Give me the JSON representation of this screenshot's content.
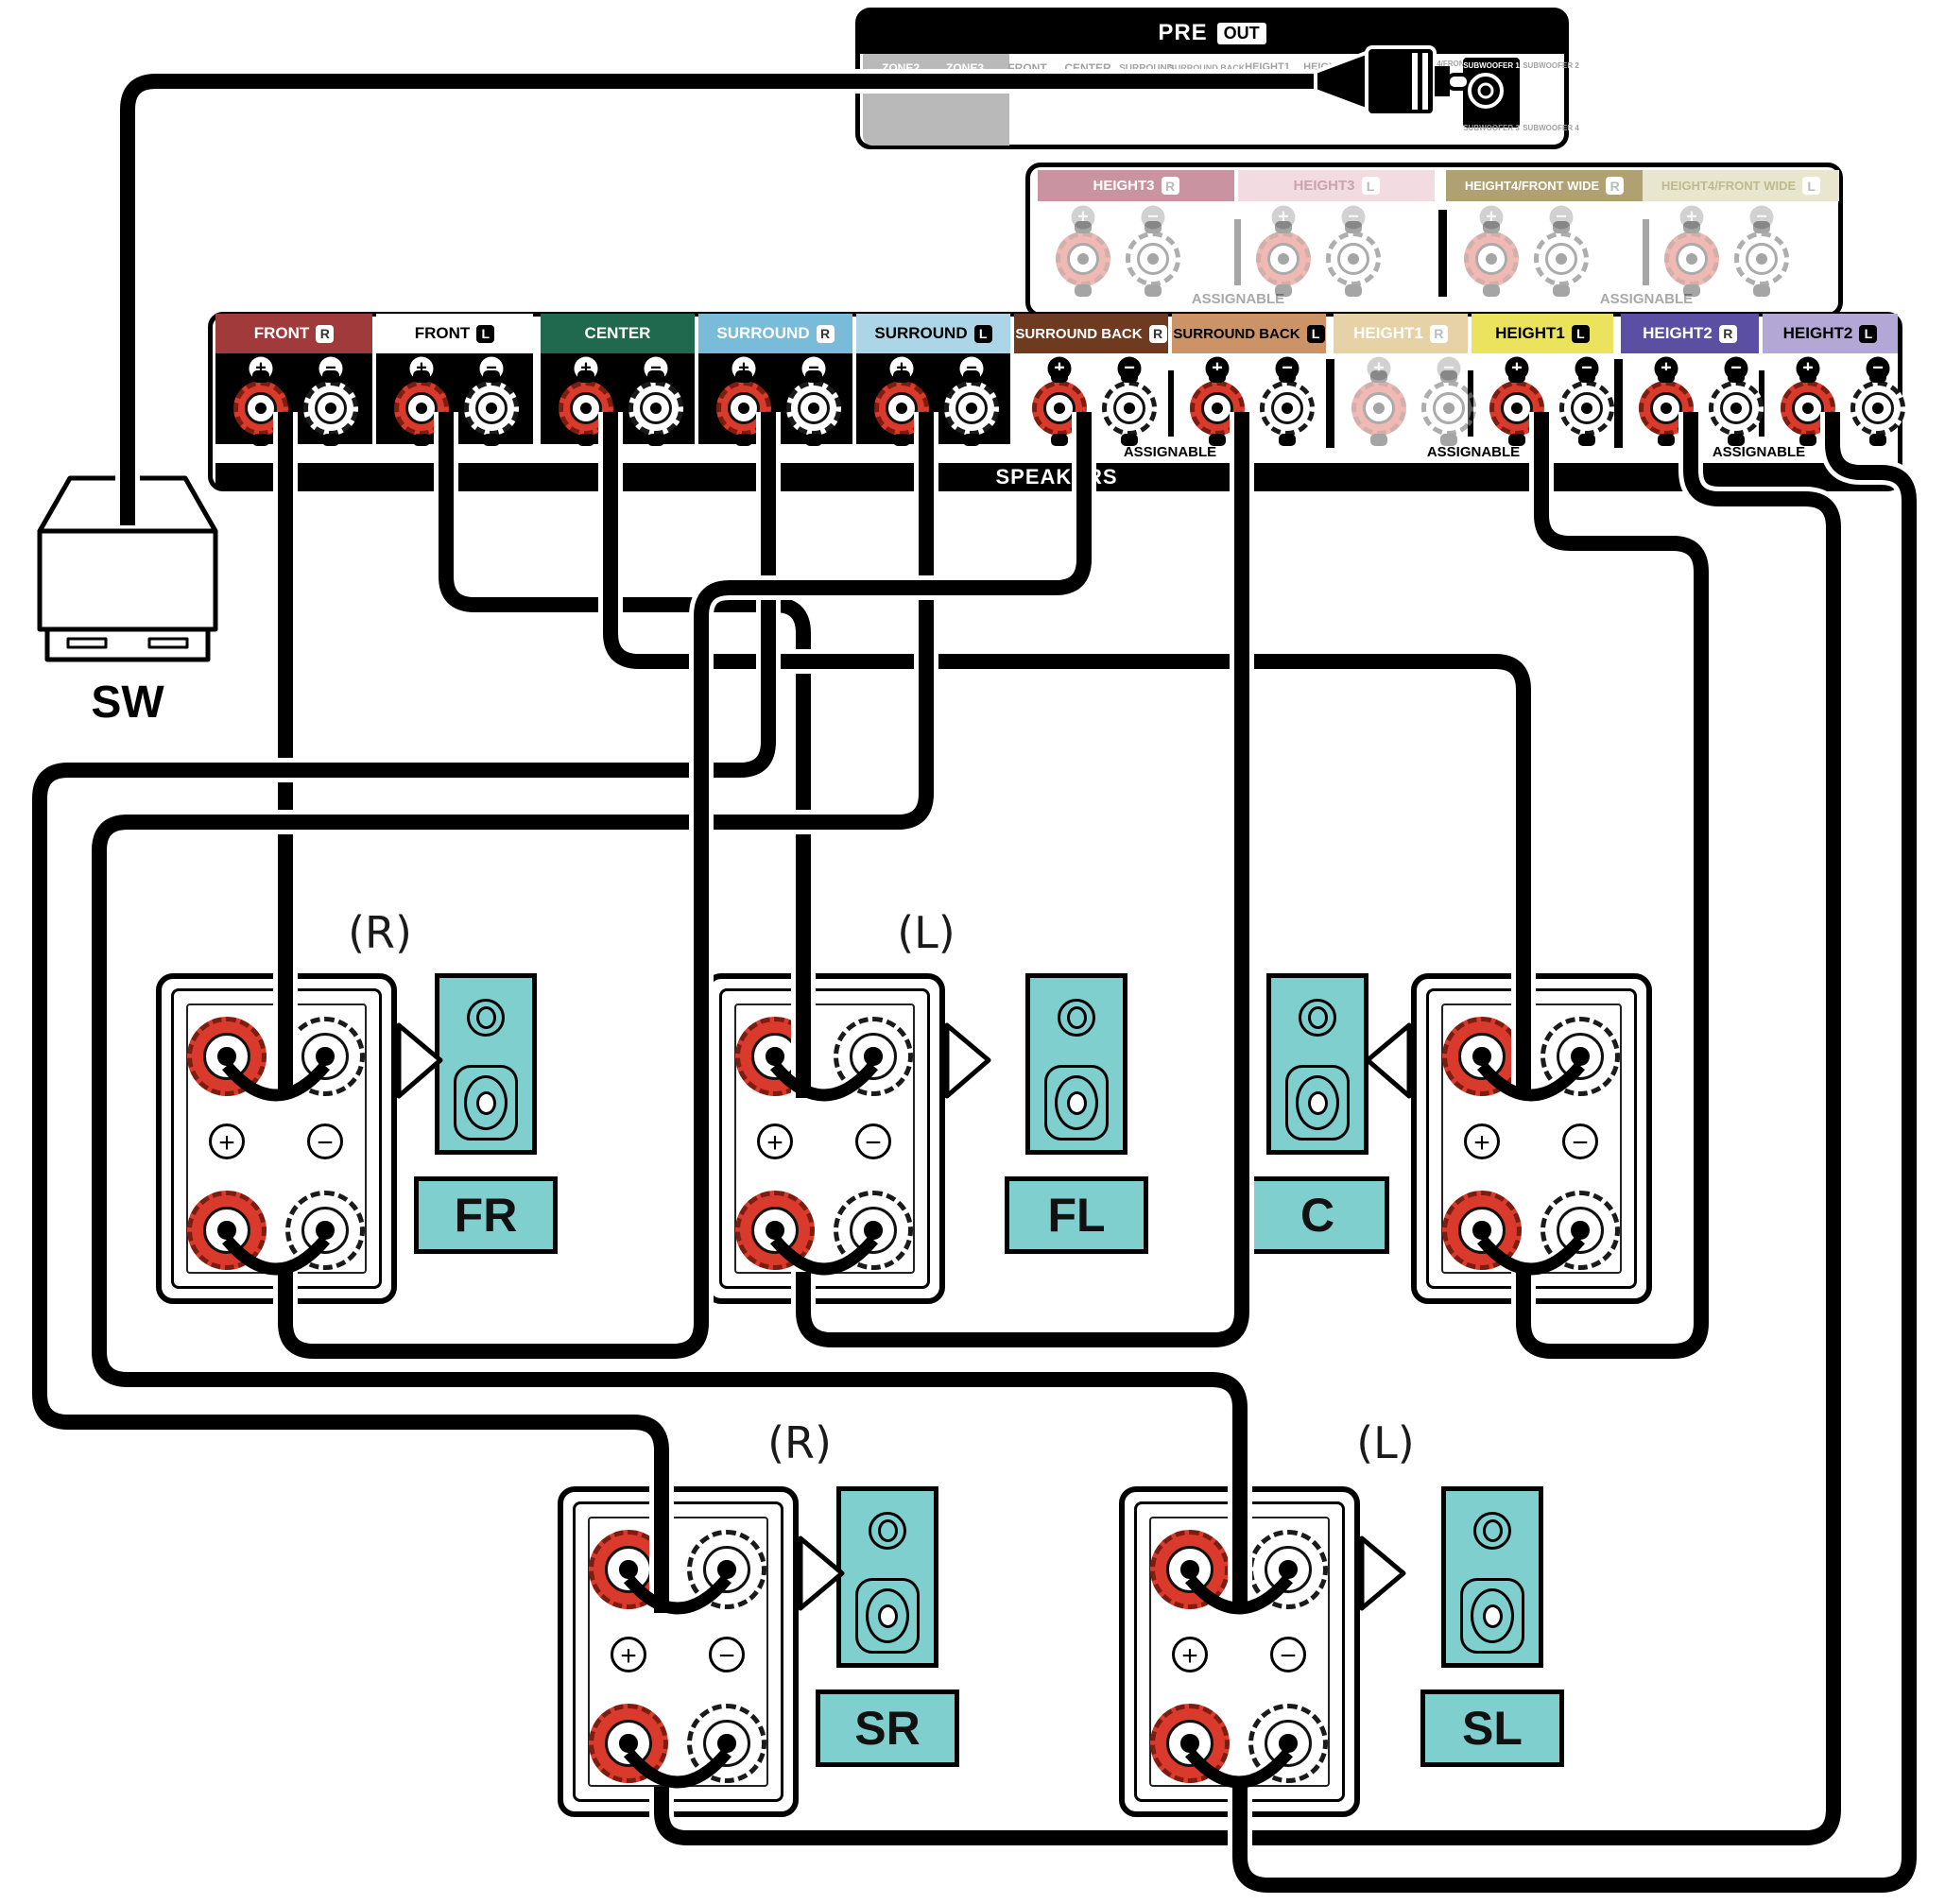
{
  "pre_out": {
    "pre": "PRE",
    "out": "OUT",
    "zones": [
      "ZONE2",
      "ZONE3"
    ],
    "channels": [
      "FRONT",
      "CENTER",
      "SURROUND",
      "SURROUND BACK",
      "HEIGHT1",
      "HEIGHT2",
      "HEIGHT3",
      "HEIGHT4/FRONT WIDE"
    ],
    "subwoofers": [
      "SUBWOOFER 1",
      "SUBWOOFER 2",
      "SUBWOOFER 3",
      "SUBWOOFER 4"
    ]
  },
  "h34": {
    "assignable": "ASSIGNABLE",
    "terminals": [
      {
        "label": "HEIGHT3",
        "ch": "R",
        "bg": "#CA93A2",
        "fg": "#FFFFFF"
      },
      {
        "label": "HEIGHT3",
        "ch": "L",
        "bg": "#F2DCE2",
        "fg": "#CBA3AF"
      },
      {
        "label": "HEIGHT4/FRONT WIDE",
        "ch": "R",
        "bg": "#AFA172",
        "fg": "#FFFFFF"
      },
      {
        "label": "HEIGHT4/FRONT WIDE",
        "ch": "L",
        "bg": "#E9E6D0",
        "fg": "#BFB98E"
      }
    ]
  },
  "main": {
    "speakers_bar": "SPEAKERS",
    "assignable": "ASSIGNABLE",
    "terminals": [
      {
        "label": "FRONT",
        "ch": "R",
        "bg": "#A13B3B",
        "fg": "#FFFFFF",
        "badge": "light"
      },
      {
        "label": "FRONT",
        "ch": "L",
        "bg": "#FFFFFF",
        "fg": "#000000",
        "badge": "dark"
      },
      {
        "label": "CENTER",
        "ch": "",
        "bg": "#20684E",
        "fg": "#FFFFFF",
        "badge": "light"
      },
      {
        "label": "SURROUND",
        "ch": "R",
        "bg": "#79BCD9",
        "fg": "#FFFFFF",
        "badge": "light"
      },
      {
        "label": "SURROUND",
        "ch": "L",
        "bg": "#ACD6E8",
        "fg": "#000000",
        "badge": "dark"
      },
      {
        "label": "SURROUND BACK",
        "ch": "R",
        "bg": "#6E3A20",
        "fg": "#FFFFFF",
        "badge": "light"
      },
      {
        "label": "SURROUND BACK",
        "ch": "L",
        "bg": "#CC9366",
        "fg": "#000000",
        "badge": "dark"
      },
      {
        "label": "HEIGHT1",
        "ch": "R",
        "bg": "#E7D2A7",
        "fg": "#FFFFFF",
        "badge": "fade"
      },
      {
        "label": "HEIGHT1",
        "ch": "L",
        "bg": "#EBE35E",
        "fg": "#000000",
        "badge": "dark"
      },
      {
        "label": "HEIGHT2",
        "ch": "R",
        "bg": "#5A4FA2",
        "fg": "#FFFFFF",
        "badge": "light"
      },
      {
        "label": "HEIGHT2",
        "ch": "L",
        "bg": "#B3A7D5",
        "fg": "#000000",
        "badge": "dark"
      }
    ]
  },
  "glyphs": {
    "plus": "+",
    "minus": "−"
  },
  "labels": {
    "sw": "SW",
    "r_tag": "(R)",
    "l_tag": "(L)",
    "fr": "FR",
    "fl": "FL",
    "c": "C",
    "sr": "SR",
    "sl": "SL"
  },
  "colors": {
    "speaker_teal": "#7FCFCE",
    "cable": "#000000",
    "post_red": "#D93A2B"
  }
}
